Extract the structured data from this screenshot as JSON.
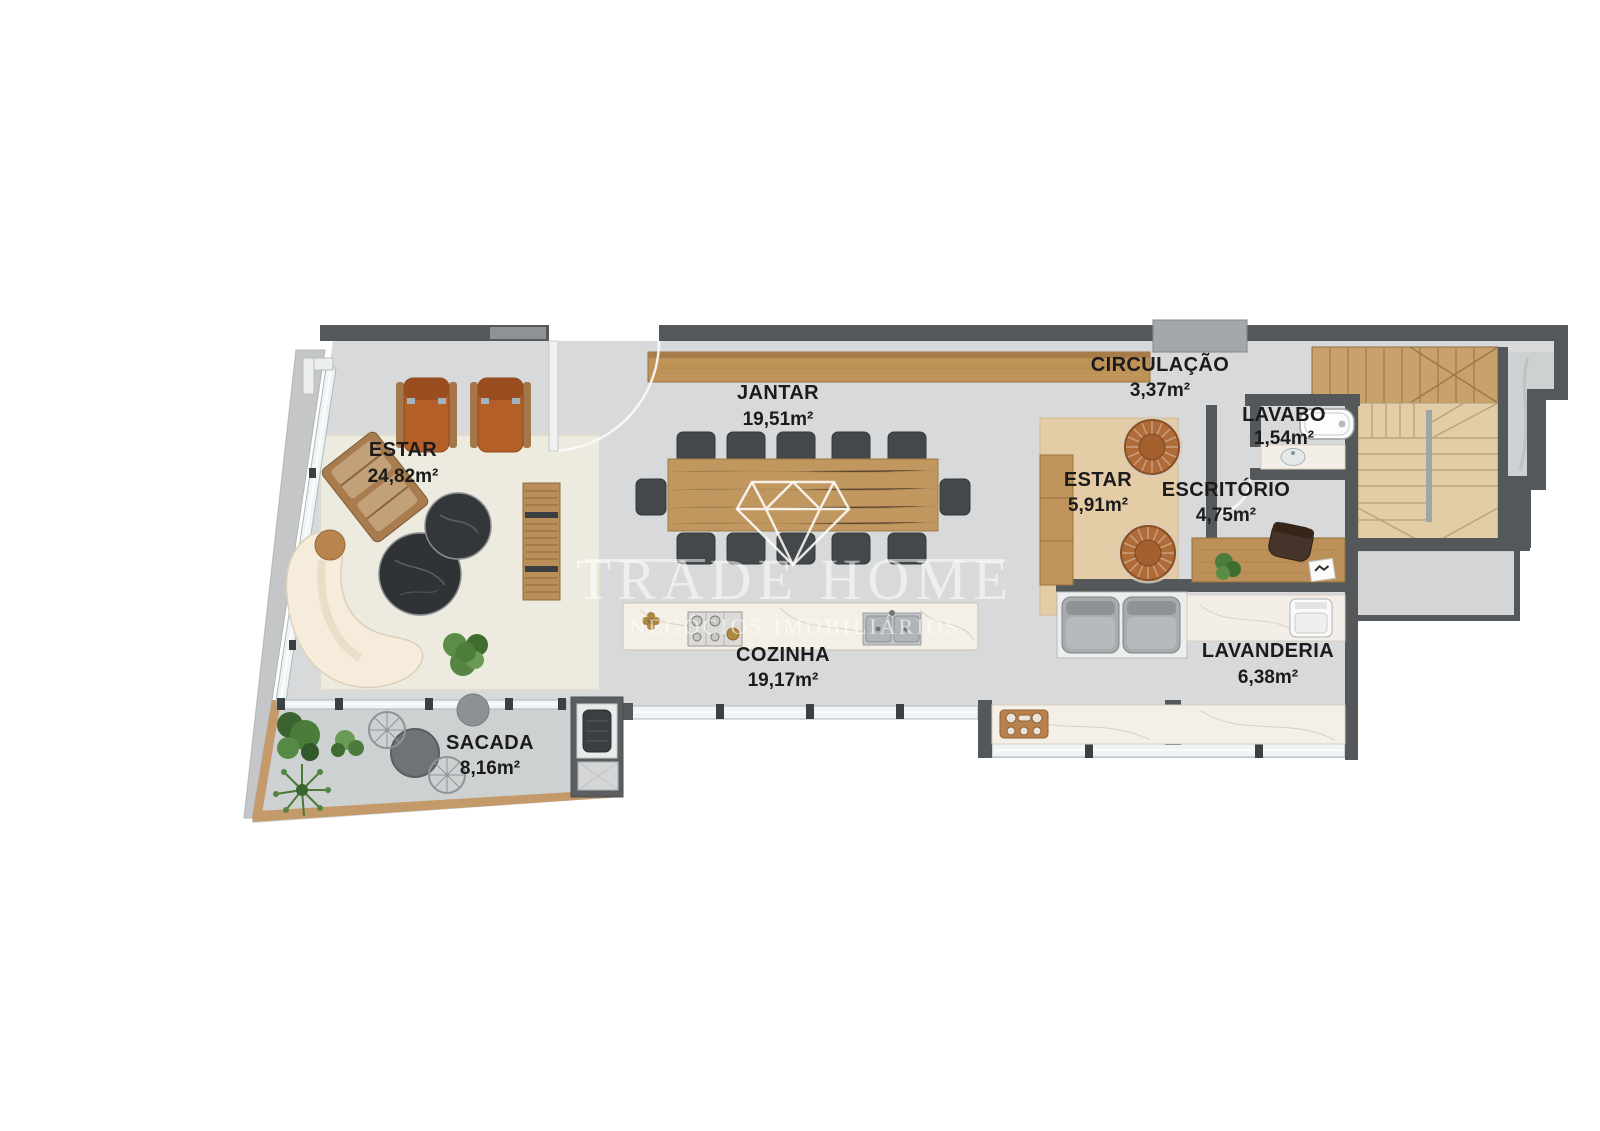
{
  "watermark": {
    "brand": "TRADE HOME",
    "tagline": "NEGÓCIOS IMOBILIÁRIOS",
    "icon": "diamond-outline-icon",
    "color": "#ffffff"
  },
  "rooms": [
    {
      "id": "estar-principal",
      "name": "ESTAR",
      "area": "24,82m²"
    },
    {
      "id": "jantar",
      "name": "JANTAR",
      "area": "19,51m²"
    },
    {
      "id": "circulacao",
      "name": "CIRCULAÇÃO",
      "area": "3,37m²"
    },
    {
      "id": "lavabo",
      "name": "LAVABO",
      "area": "1,54m²"
    },
    {
      "id": "estar-intimo",
      "name": "ESTAR",
      "area": "5,91m²"
    },
    {
      "id": "escritorio",
      "name": "ESCRITÓRIO",
      "area": "4,75m²"
    },
    {
      "id": "cozinha",
      "name": "COZINHA",
      "area": "19,17m²"
    },
    {
      "id": "lavanderia",
      "name": "LAVANDERIA",
      "area": "6,38m²"
    },
    {
      "id": "sacada",
      "name": "SACADA",
      "area": "8,16m²"
    }
  ],
  "palette": {
    "wall": "#54585b",
    "floor": "#d7d9da",
    "balcony_floor": "#ced1d2",
    "concrete": "#c5c6c7",
    "wood": "#bf9257",
    "light_wood": "#e3cda6",
    "rug_cream": "#edeae0",
    "rug_beige": "#e4cda6",
    "marble": "#f4f0e8",
    "glass": "#eff4f5",
    "furniture_dark": "#44484b",
    "leather_orange": "#b45f28",
    "plant_green": "#4c7c3c",
    "watermark_white": "#ffffff"
  }
}
